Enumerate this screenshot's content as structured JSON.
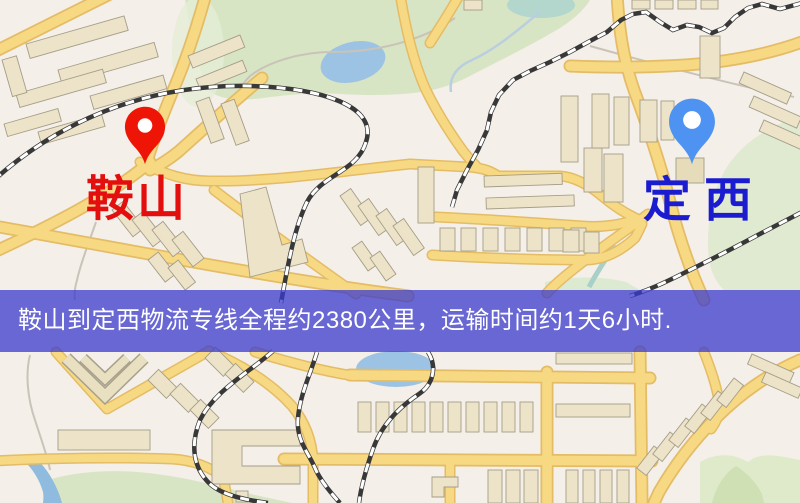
{
  "markers": [
    {
      "role": "origin",
      "label": "鞍山",
      "pin_color": "#ee1507",
      "label_color": "#e30f0f"
    },
    {
      "role": "destination",
      "label": "定西",
      "pin_color": "#4f93f2",
      "label_color": "#1b1bd0"
    }
  ],
  "banner": {
    "text": "鞍山到定西物流专线全程约2380公里，运输时间约1天6小时.",
    "distance_text": "约2380公里",
    "duration_text": "约1天6小时",
    "background_color": "rgba(58,58,205,0.75)",
    "text_color": "#ffffff"
  },
  "map_palette": {
    "background": "#f4efe8",
    "park_green": "#d8e5c5",
    "water_blue": "#9cc3e4",
    "road_yellow": "#f7d983",
    "road_casing": "#e4bc66",
    "building_fill": "#ece3c8",
    "railway_dark": "#383838"
  }
}
